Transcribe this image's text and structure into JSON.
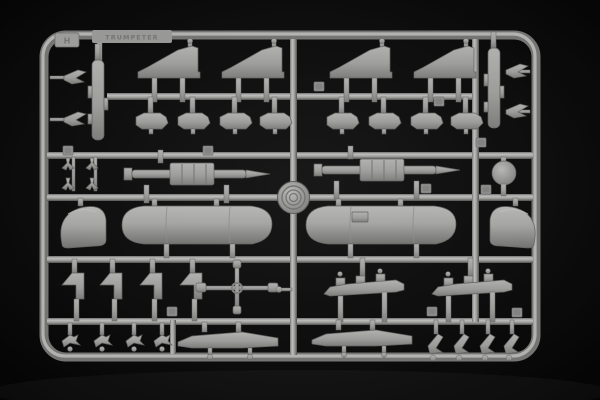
{
  "scene": {
    "type": "photograph",
    "description": "Light-grey injection-moulded plastic model kit sprue (parts runner) with aircraft weapon and store parts, photographed on a black background",
    "background_color": "#0d0d0d",
    "plastic_color": "#c4c4c2",
    "plastic_highlight": "#e8e8e6",
    "plastic_shadow": "#6e6e6c"
  },
  "sprue": {
    "brand_stamp": "TRUMPETER",
    "corner_tab_label": "H",
    "hub_type": "circular injection hub with concentric rings",
    "parts_inventory": [
      {
        "part": "horizontal-stabilizer-fin",
        "count": 4
      },
      {
        "part": "pylon-adapter-shoe",
        "count": 8
      },
      {
        "part": "missile-body-half",
        "count": 2
      },
      {
        "part": "small-winglet",
        "count": 4
      },
      {
        "part": "antenna-y-part",
        "count": 4
      },
      {
        "part": "rocket-with-fin-sleeve",
        "count": 2
      },
      {
        "part": "sensor-ball",
        "count": 1
      },
      {
        "part": "drop-tank-half",
        "count": 2
      },
      {
        "part": "intake-nose-cone",
        "count": 2
      },
      {
        "part": "weapon-pylon",
        "count": 4
      },
      {
        "part": "cross-runner-small-parts",
        "count": 1
      },
      {
        "part": "multiple-ejector-rack",
        "count": 2
      },
      {
        "part": "bomb-tail-fin",
        "count": 8
      },
      {
        "part": "missile-launch-rail",
        "count": 2
      }
    ]
  }
}
